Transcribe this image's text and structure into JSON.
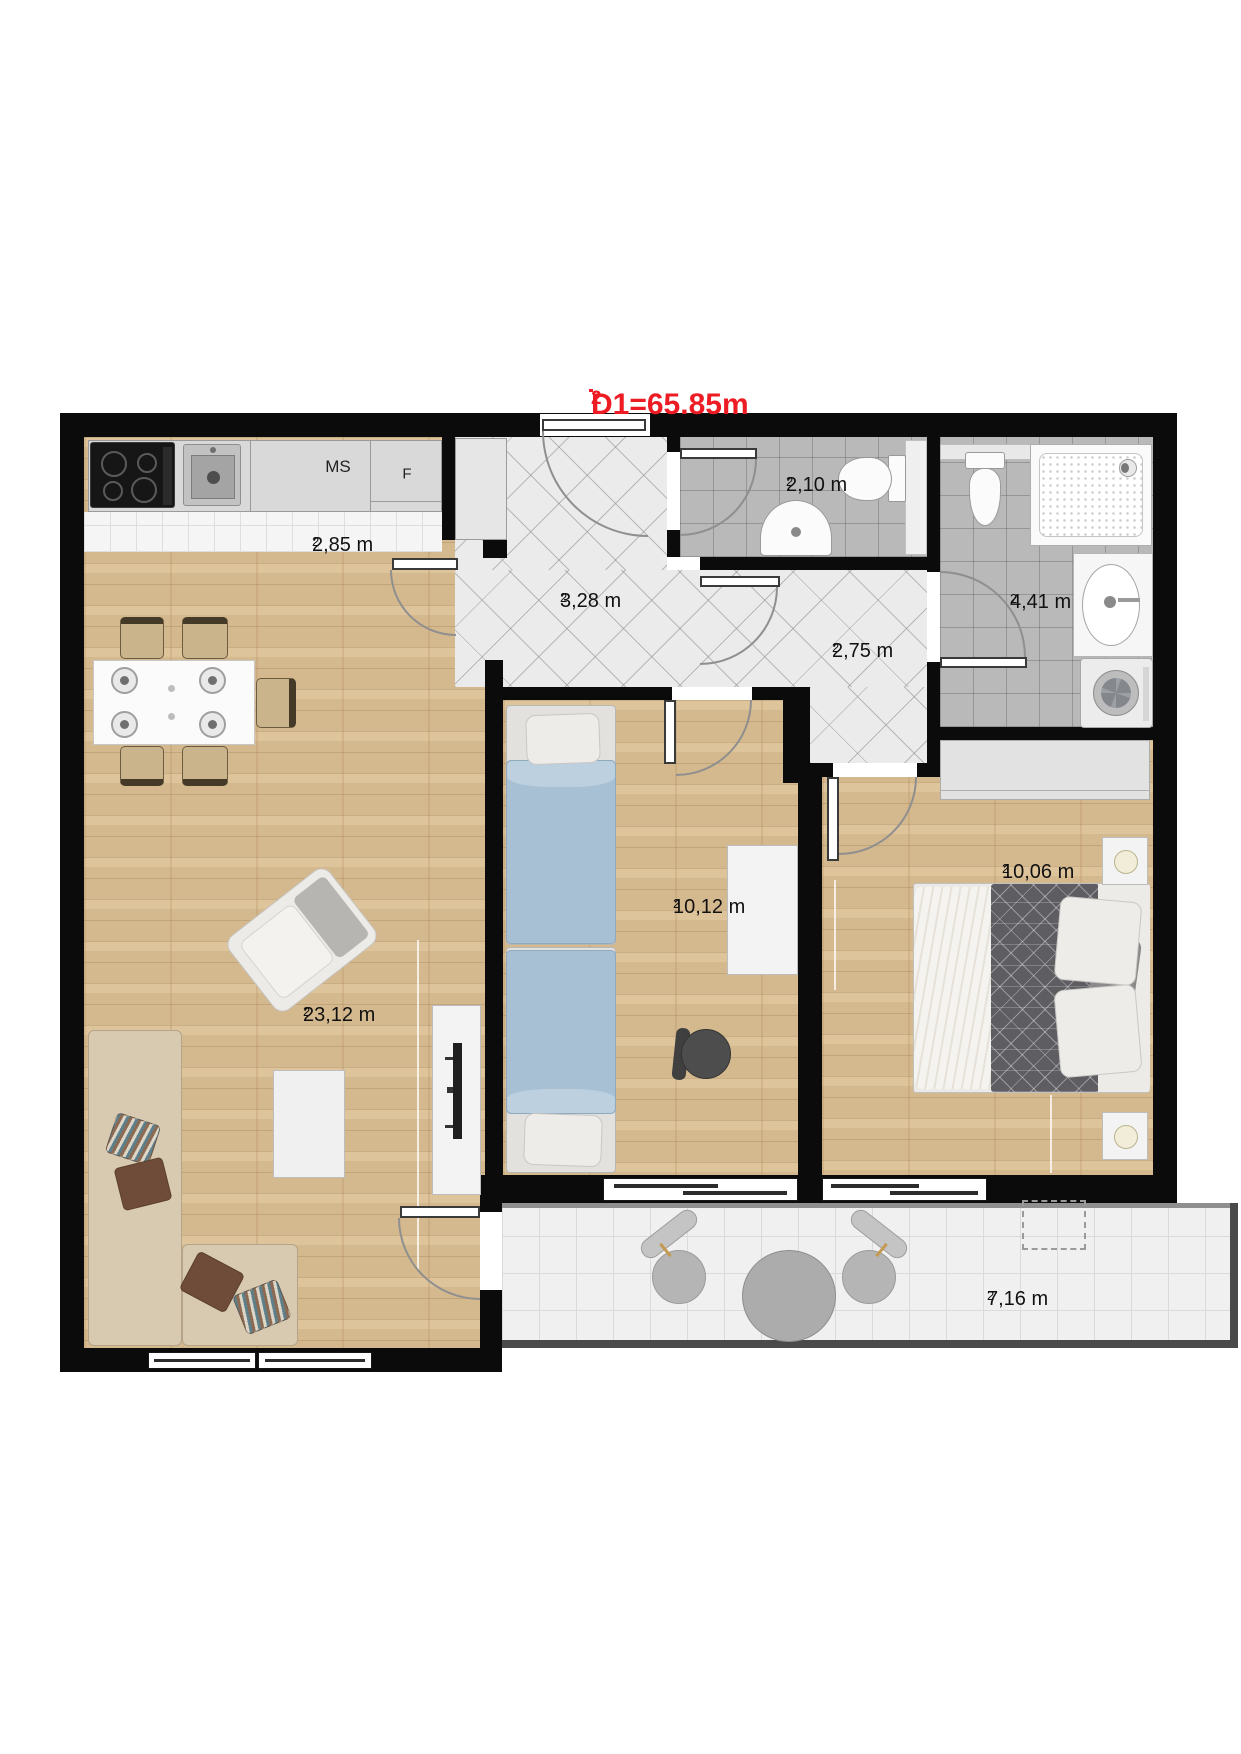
{
  "sup2": "2",
  "title": {
    "text": "D1=65.85m",
    "sup": "2"
  },
  "total_area_m2": "65.85",
  "kitchen": {
    "ms_label": "MS",
    "fridge_label": "F"
  },
  "rooms": [
    {
      "id": "kitchen",
      "area": "2,85 m"
    },
    {
      "id": "entry-hall",
      "area": "3,28 m"
    },
    {
      "id": "wc",
      "area": "2,10 m"
    },
    {
      "id": "corridor",
      "area": "2,75 m"
    },
    {
      "id": "bathroom",
      "area": "4,41 m"
    },
    {
      "id": "living-room",
      "area": "23,12 m"
    },
    {
      "id": "bedroom-1",
      "area": "10,12 m"
    },
    {
      "id": "bedroom-2",
      "area": "10,06 m"
    },
    {
      "id": "balcony",
      "area": "7,16 m"
    }
  ],
  "colors": {
    "accent_red": "#ed1c24",
    "wall_black": "#0b0b0b",
    "wood_floor": "#dcbf93",
    "hallway_tile": "#ebebeb",
    "bathroom_tile": "#b9b9b9",
    "kitchen_tile": "#f5f5f5",
    "duvet_blue": "#a7c0d4",
    "sofa_tan": "#d8c9b1"
  }
}
